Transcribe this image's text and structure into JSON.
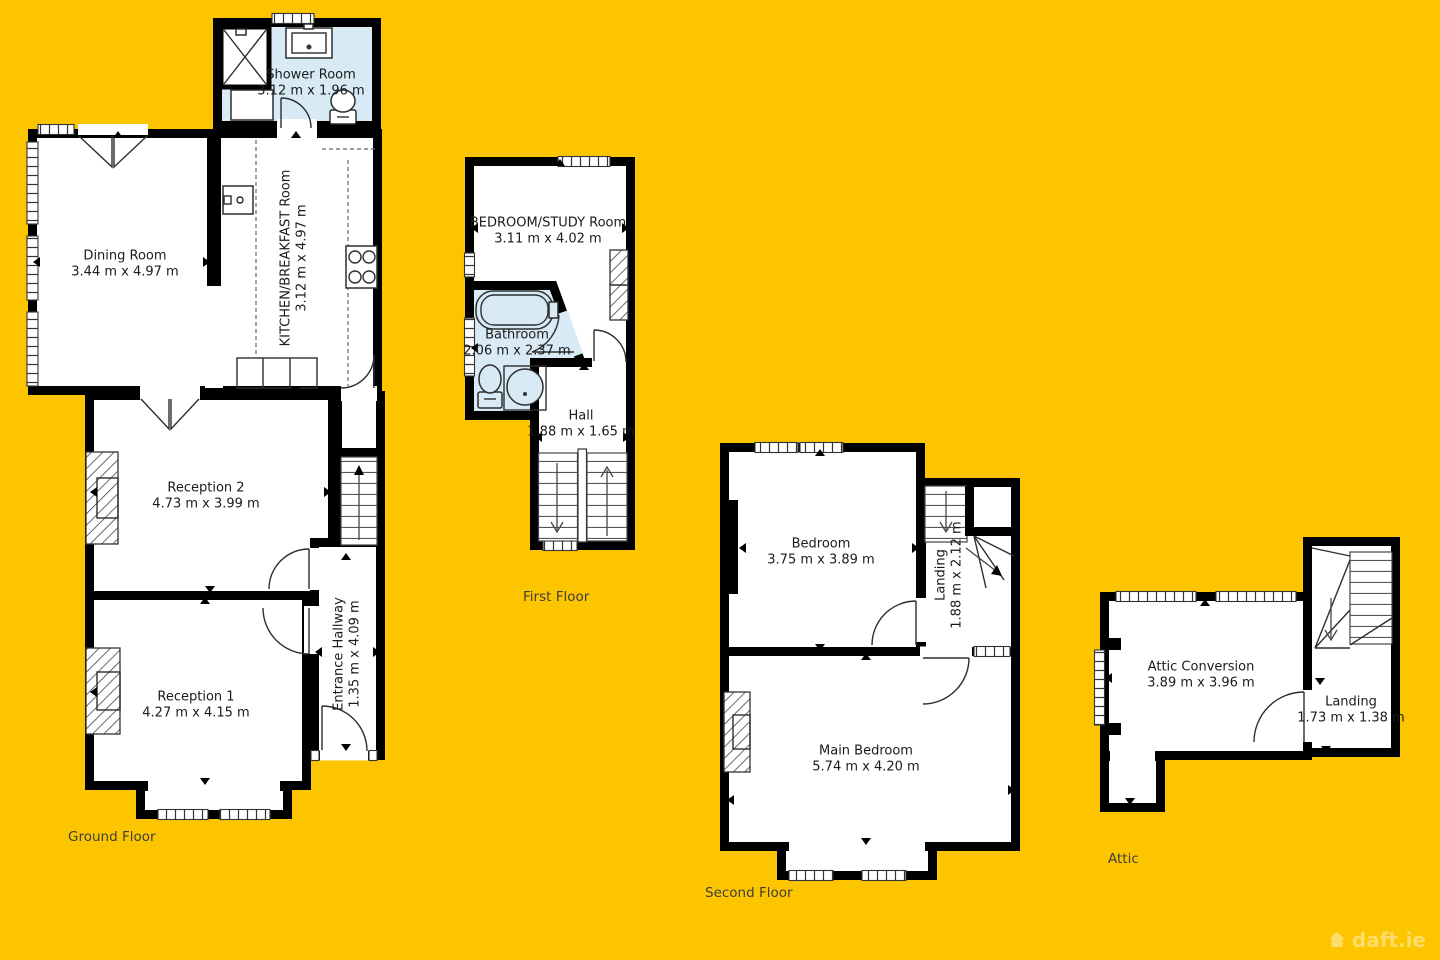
{
  "colors": {
    "background": "#FDC500",
    "wall": "#000000",
    "room": "#FFFFFF",
    "wet_room": "#D8EAF6"
  },
  "watermark": {
    "text": "daft.ie",
    "icon": "house-icon"
  },
  "floors": [
    {
      "label": "Ground Floor",
      "rooms": [
        {
          "name": "Shower Room",
          "dims": "3.12 m x 1.96 m"
        },
        {
          "name": "Dining Room",
          "dims": "3.44 m x 4.97 m"
        },
        {
          "name": "KITCHEN/BREAKFAST Room",
          "dims": "3.12 m x 4.97 m"
        },
        {
          "name": "Reception 2",
          "dims": "4.73 m x 3.99 m"
        },
        {
          "name": "Reception 1",
          "dims": "4.27 m x 4.15 m"
        },
        {
          "name": "Entrance Hallway",
          "dims": "1.35 m x 4.09 m"
        }
      ]
    },
    {
      "label": "First Floor",
      "rooms": [
        {
          "name": "BEDROOM/STUDY Room",
          "dims": "3.11 m x 4.02 m"
        },
        {
          "name": "Bathroom",
          "dims": "2.06 m x 2.37 m"
        },
        {
          "name": "Hall",
          "dims": "1.88 m x 1.65 m"
        }
      ]
    },
    {
      "label": "Second Floor",
      "rooms": [
        {
          "name": "Bedroom",
          "dims": "3.75 m x 3.89 m"
        },
        {
          "name": "Landing",
          "dims": "1.88 m x 2.12 m"
        },
        {
          "name": "Main Bedroom",
          "dims": "5.74 m x 4.20 m"
        }
      ]
    },
    {
      "label": "Attic",
      "rooms": [
        {
          "name": "Attic Conversion",
          "dims": "3.89 m x 3.96 m"
        },
        {
          "name": "Landing",
          "dims": "1.73 m x 1.38 m"
        }
      ]
    }
  ]
}
